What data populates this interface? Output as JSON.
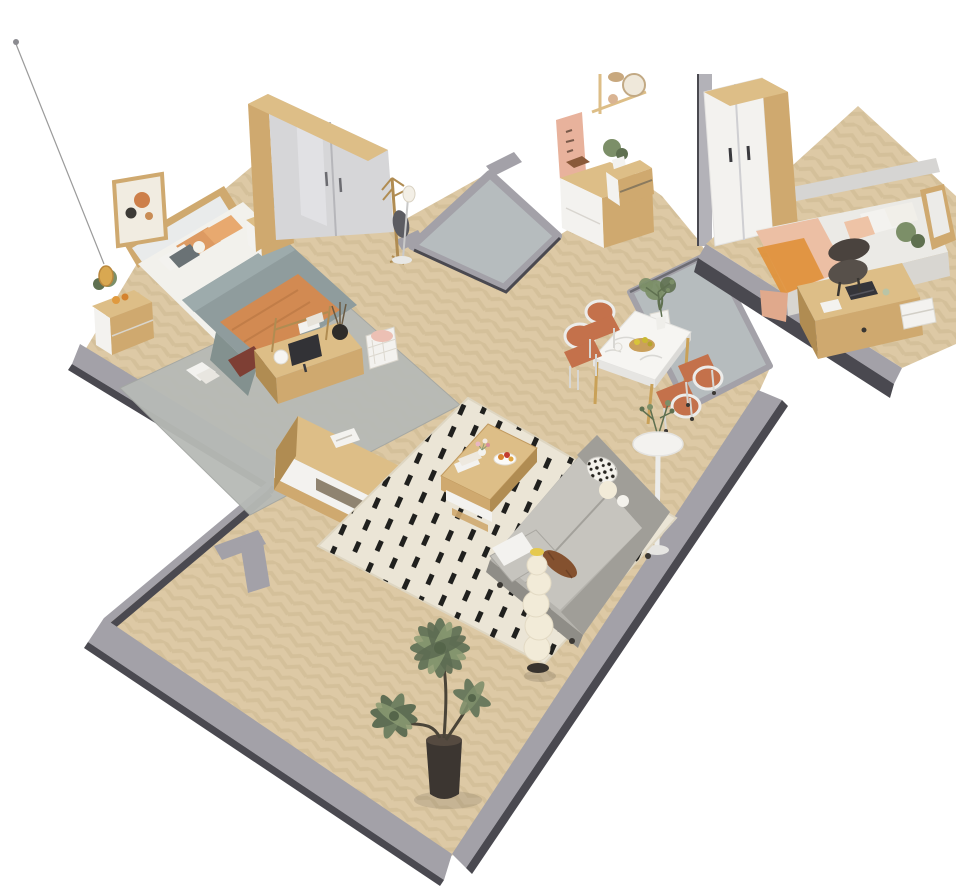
{
  "image": {
    "title": "Isometric 3D render of a furnished apartment floor plan",
    "style": "Scandinavian-style cutaway apartment with herringbone wood floors, low grey walls and concrete pads",
    "background": "#ffffff"
  },
  "palette": {
    "bg": "#ffffff",
    "floorWood": "#ddc9a5",
    "floorWoodDark": "#c6af88",
    "concrete": "#b6bcbe",
    "wallGray": "#a3a1a8",
    "wallDark": "#4a4950",
    "wood": "#cfa96f",
    "woodDark": "#b08c52",
    "woodLight": "#ddBE87",
    "furnWhite": "#f3f2ef",
    "wardrobeDoor": "#d6d6d8",
    "sheet": "#f2f1ec",
    "duvet": "#8f9c9d",
    "throw": "#d28a52",
    "pillowOrange": "#dd9a62",
    "terracotta": "#c4714b",
    "peach": "#ecbfa4",
    "orange2": "#e09038",
    "marble": "#f6f5f2",
    "sofa": "#b5b3ad",
    "sofaLight": "#c6c4be",
    "sofaDark": "#a09e98",
    "rugCream": "#ebe5d6",
    "rugDash": "#20201e",
    "rugGray": "#b7bab6",
    "plantGreen": "#7c8f68",
    "plantDark": "#5f7050",
    "palmGreen": "#68775b",
    "amber": "#d9a851",
    "creamLamp": "#f2ebd8",
    "maroon": "#7e3f34"
  },
  "rooms": {
    "master_bedroom": {
      "label": "Master bedroom",
      "furniture": [
        "Double bed with grey duvet and orange throw",
        "Sliding-door wardrobe",
        "Nightstand with plant and fruit",
        "Nightstand with plant and clock",
        "Framed wall art",
        "Hanging pendant lamp",
        "Coat rack with bag",
        "Floor lamp",
        "Desk with monitor, shelf and basket",
        "Grey rug with book",
        "TV console with magazine"
      ]
    },
    "entry": {
      "label": "Entry hall",
      "furniture": [
        "Concrete entry pad",
        "Sideboard with plant and decor shelf",
        "Pink wall hanging",
        "Low shoe shelf"
      ]
    },
    "second_bedroom": {
      "label": "Second bedroom",
      "furniture": [
        "Single bed with peach blanket",
        "Two-door wardrobe",
        "Desk with laptop and chair",
        "Drawer unit",
        "Raised wood platform"
      ]
    },
    "dining_area": {
      "label": "Dining area",
      "furniture": [
        "White marble dining table",
        "Four chairs with terracotta seats",
        "Fruit bowl",
        "Branch vase",
        "Round pedestal side table with plant",
        "Concrete pad with potted tree"
      ]
    },
    "living_room": {
      "label": "Living room",
      "furniture": [
        "Grey fabric sofa with patterned cushions and bolster",
        "Wooden coffee table with books, flowers and fruit plate",
        "Cream rug with black dash pattern",
        "Stacked-sphere floor lamp",
        "Large potted palm"
      ]
    }
  }
}
